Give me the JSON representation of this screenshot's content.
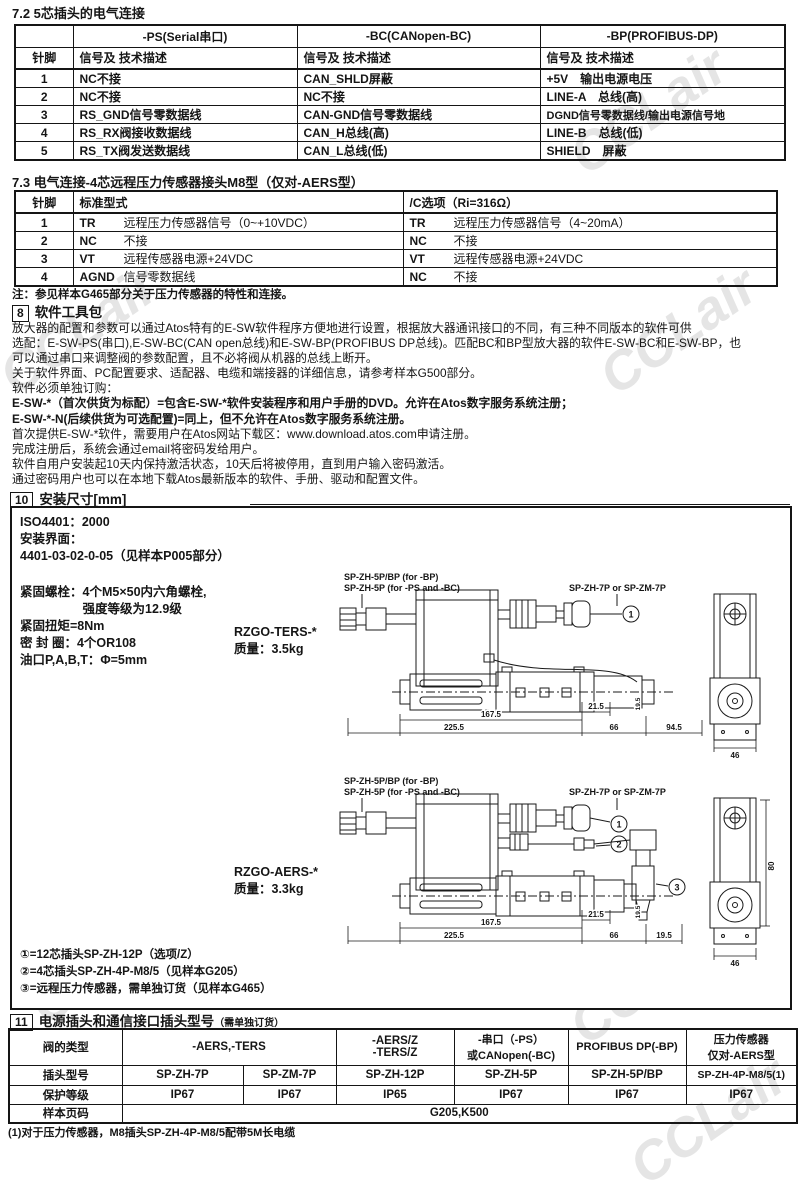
{
  "watermark": "CCLair",
  "sec72": {
    "title": "7.2  5芯插头的电气连接",
    "table": {
      "pin_header": "针脚",
      "desc_header": "信号及 技术描述",
      "col_ps": "-PS(Serial串口)",
      "col_bc": "-BC(CANopen-BC)",
      "col_bp": "-BP(PROFIBUS-DP)",
      "rows": [
        {
          "pin": "1",
          "ps": "NC不接",
          "bc": "CAN_SHLD屏蔽",
          "bp": "+5V　输出电源电压"
        },
        {
          "pin": "2",
          "ps": "NC不接",
          "bc": "NC不接",
          "bp": "LINE-A　总线(高)"
        },
        {
          "pin": "3",
          "ps": "RS_GND信号零数据线",
          "bc": "CAN-GND信号零数据线",
          "bp": "DGND信号零数据线/输出电源信号地"
        },
        {
          "pin": "4",
          "ps": "RS_RX阀接收数据线",
          "bc": "CAN_H总线(高)",
          "bp": "LINE-B　总线(低)"
        },
        {
          "pin": "5",
          "ps": "RS_TX阀发送数据线",
          "bc": "CAN_L总线(低)",
          "bp": "SHIELD　屏蔽"
        }
      ]
    }
  },
  "sec73": {
    "title": "7.3 电气连接-4芯远程压力传感器接头M8型（仅对-AERS型）",
    "table": {
      "pin_header": "针脚",
      "std_header": "标准型式",
      "c_header": "/C选项（Ri=316Ω）",
      "rows": [
        {
          "pin": "1",
          "std_code": "TR",
          "std_desc": "远程压力传感器信号（0~+10VDC）",
          "c_code": "TR",
          "c_desc": "远程压力传感器信号（4~20mA）"
        },
        {
          "pin": "2",
          "std_code": "NC",
          "std_desc": "不接",
          "c_code": "NC",
          "c_desc": "不接"
        },
        {
          "pin": "3",
          "std_code": "VT",
          "std_desc": "远程传感器电源+24VDC",
          "c_code": "VT",
          "c_desc": "远程传感器电源+24VDC"
        },
        {
          "pin": "4",
          "std_code": "AGND",
          "std_desc": "信号零数据线",
          "c_code": "NC",
          "c_desc": "不接"
        }
      ]
    },
    "note": "注：参见样本G465部分关于压力传感器的特性和连接。"
  },
  "sec8": {
    "num": "8",
    "title": "软件工具包",
    "lines": [
      "放大器的配置和参数可以通过Atos特有的E-SW软件程序方便地进行设置，根据放大器通讯接口的不同，有三种不同版本的软件可供",
      "选配：E-SW-PS(串口),E-SW-BC(CAN open总线)和E-SW-BP(PROFIBUS DP总线)。匹配BC和BP型放大器的软件E-SW-BC和E-SW-BP，也",
      "可以通过串口来调整阀的参数配置，且不必将阀从机器的总线上断开。",
      "关于软件界面、PC配置要求、适配器、电缆和端接器的详细信息，请参考样本G500部分。",
      "软件必须单独订购：",
      "E-SW-*（首次供货为标配）=包含E-SW-*软件安装程序和用户手册的DVD。允许在Atos数字服务系统注册；",
      "E-SW-*-N(后续供货为可选配置)=同上，但不允许在Atos数字服务系统注册。",
      "首次提供E-SW-*软件，需要用户在Atos网站下载区：www.download.atos.com申请注册。",
      "完成注册后，系统会通过email将密码发给用户。",
      "软件自用户安装起10天内保持激活状态，10天后将被停用，直到用户输入密码激活。",
      "通过密码用户也可以在本地下载Atos最新版本的软件、手册、驱动和配置文件。"
    ]
  },
  "sec10": {
    "num": "10",
    "title": "安装尺寸[mm]",
    "iso_lines": [
      "ISO4401：2000",
      "安装界面：",
      "4401-03-02-0-05（见样本P005部分）"
    ],
    "mount_lines": [
      "紧固螺栓：4个M5×50内六角螺栓,",
      "　　　　　强度等级为12.9级",
      "紧固扭矩=8Nm",
      "密 封 圈：4个OR108",
      "油口P,A,B,T：Φ=5mm"
    ],
    "model1_name": "RZGO-TERS-*",
    "model1_weight": "质量：3.5kg",
    "model2_name": "RZGO-AERS-*",
    "model2_weight": "质量：3.3kg",
    "conn_bp": "SP-ZH-5P/BP (for -BP)",
    "conn_psbc": "SP-ZH-5P (for -PS and -BC)",
    "conn_7p": "SP-ZH-7P or SP-ZM-7P",
    "callouts": {
      "c1": "1",
      "c2": "2",
      "c3": "3"
    },
    "dims1": {
      "d167": "167.5",
      "d225": "225.5",
      "d215": "21.5",
      "d66": "66",
      "d945": "94.5",
      "d46": "46",
      "d19v": "19.5"
    },
    "dims2": {
      "d167": "167.5",
      "d225": "225.5",
      "d215": "21.5",
      "d66": "66",
      "d195": "19.5",
      "d46": "46",
      "d19v": "19.5",
      "d80": "80"
    },
    "footnotes": [
      "①=12芯插头SP-ZH-12P（选项/Z）",
      "②=4芯插头SP-ZH-4P-M8/5（见样本G205）",
      "③=远程压力传感器，需单独订货（见样本G465）"
    ]
  },
  "sec11": {
    "num": "11",
    "title": "电源插头和通信接口插头型号",
    "title_note": "（需单独订货）",
    "table": {
      "row_labels": [
        "阀的类型",
        "插头型号",
        "保护等级",
        "样本页码"
      ],
      "g1": "-AERS,-TERS",
      "g2l1": "-AERS/Z",
      "g2l2": "-TERS/Z",
      "g3l1": "-串口（-PS）",
      "g3l2": "或CANopen(-BC)",
      "g4": "PROFIBUS DP(-BP)",
      "g5l1": "压力传感器",
      "g5l2": "仅对-AERS型",
      "plugs": [
        "SP-ZH-7P",
        "SP-ZM-7P",
        "SP-ZH-12P",
        "SP-ZH-5P",
        "SP-ZH-5P/BP",
        "SP-ZH-4P-M8/5(1)"
      ],
      "ip": [
        "IP67",
        "IP67",
        "IP65",
        "IP67",
        "IP67",
        "IP67"
      ],
      "page": "G205,K500"
    },
    "footnote": "(1)对于压力传感器，M8插头SP-ZH-4P-M8/5配带5M长电缆"
  }
}
